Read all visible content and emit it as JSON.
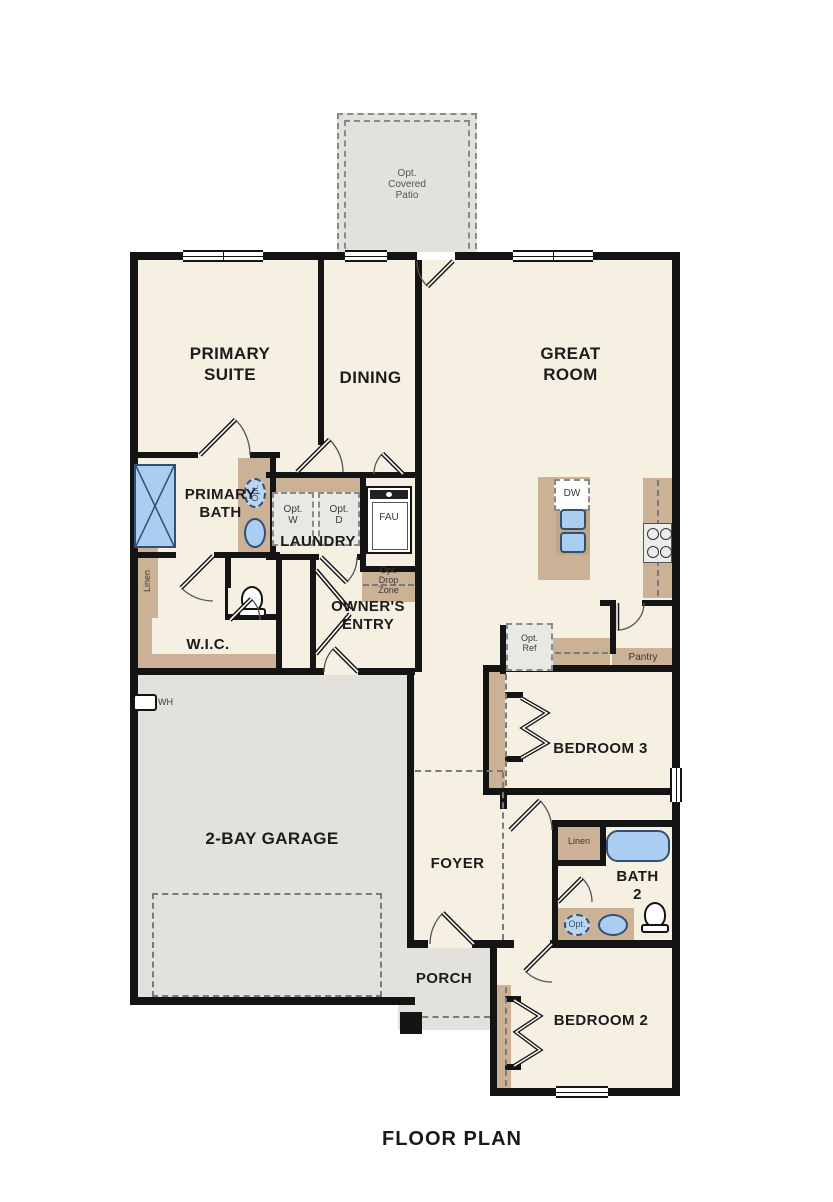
{
  "title": "FLOOR PLAN",
  "rooms": {
    "patio": "Opt.\nCovered\nPatio",
    "primary_suite": "PRIMARY\nSUITE",
    "dining": "DINING",
    "great_room": "GREAT\nROOM",
    "primary_bath": "PRIMARY\nBATH",
    "laundry": "LAUNDRY",
    "owners_entry": "OWNER'S\nENTRY",
    "wic": "W.I.C.",
    "garage": "2-BAY GARAGE",
    "foyer": "FOYER",
    "bedroom3": "BEDROOM 3",
    "bath2": "BATH\n2",
    "bedroom2": "BEDROOM 2",
    "porch": "PORCH"
  },
  "features": {
    "opt_w": "Opt.\nW",
    "opt_d": "Opt.\nD",
    "fau": "FAU",
    "drop_zone": "Opt.\nDrop\nZone",
    "linen_primary": "Linen",
    "linen_bath2": "Linen",
    "pantry": "Pantry",
    "dw": "DW",
    "opt_ref": "Opt.\nRef",
    "wh": "WH",
    "opt_sink_primary": "Opt.",
    "opt_sink_bath2": "Opt."
  },
  "colors": {
    "wall": "#141414",
    "room_fill": "#f6f0e2",
    "concrete_fill": "#e2e1dc",
    "cabinet_tan": "#cbb195",
    "fixture_blue": "#a9cef1",
    "fixture_blue_line": "#33506e"
  }
}
